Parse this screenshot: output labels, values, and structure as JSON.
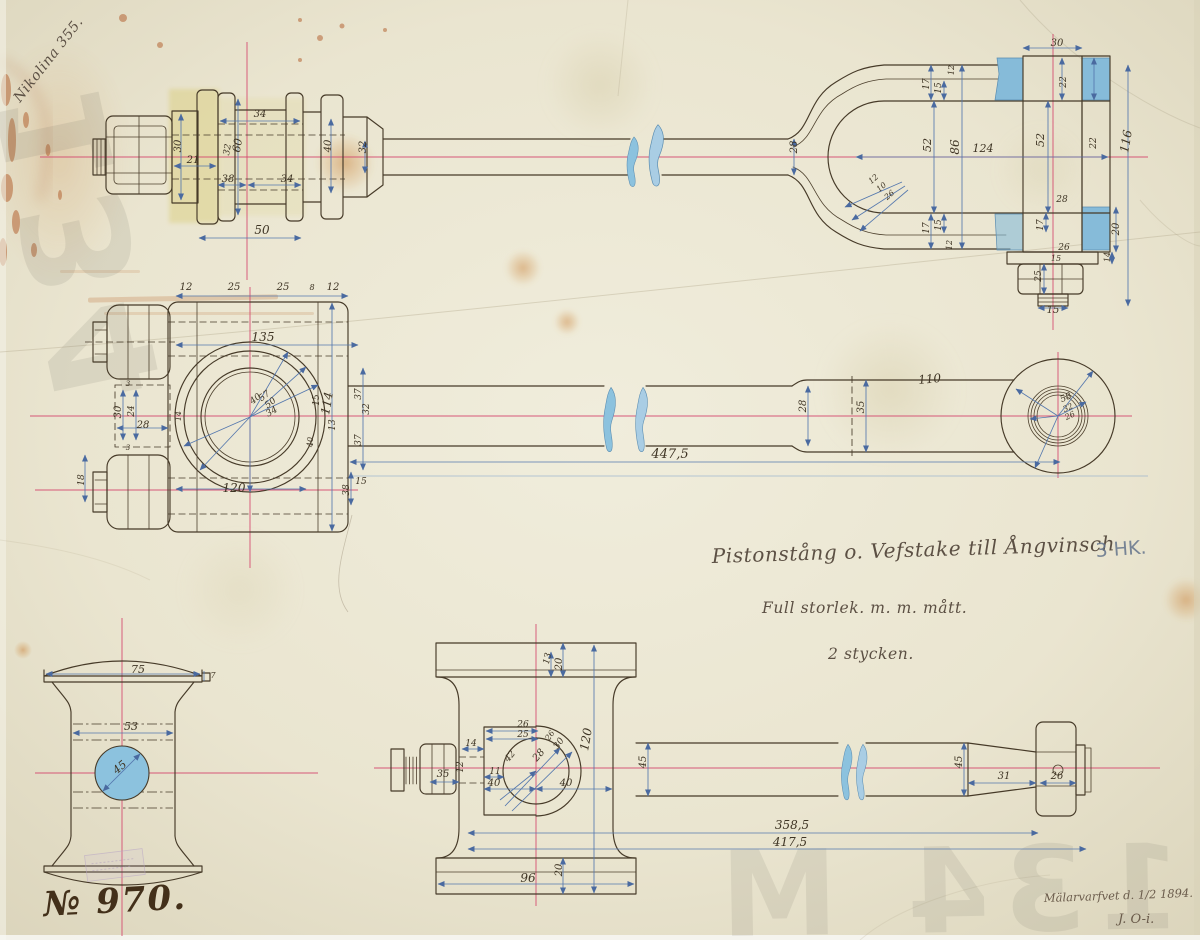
{
  "document": {
    "corner_note": "Nikolina 355.",
    "title": "Pistonstång o. Vefstake till Ångvinsch",
    "power_note": "3 HK.",
    "scale_note": "Full storlek.    m. m. mått.",
    "quantity_note": "2 stycken.",
    "drawing_number": "№ 970.",
    "signature_place_date": "Mälarvarfvet d. 1/2 1894.",
    "signature_initials": "J. O-i.",
    "watermark_top_left": "134",
    "watermark_bottom_right": "134 M"
  },
  "colors": {
    "paper": "#ece7d4",
    "ink": "#463a28",
    "dimension_blue": "#5578ae",
    "centerline_red": "#d4476e",
    "wash_blue": "#86bbd9",
    "wash_yellow": "#d6c867"
  },
  "annotations": [
    {
      "v": "side",
      "t": "34",
      "x": 260,
      "y": 117
    },
    {
      "v": "side",
      "t": "30",
      "x": 181,
      "y": 146,
      "r": -90
    },
    {
      "v": "side",
      "t": "21",
      "x": 193,
      "y": 163
    },
    {
      "v": "side",
      "t": "60",
      "x": 241,
      "y": 146,
      "r": -80,
      "s": 11
    },
    {
      "v": "side",
      "t": "32",
      "x": 230,
      "y": 150,
      "r": -80,
      "s": 9
    },
    {
      "v": "side",
      "t": "38",
      "x": 228,
      "y": 182
    },
    {
      "v": "side",
      "t": "34",
      "x": 287,
      "y": 182
    },
    {
      "v": "side",
      "t": "50",
      "x": 262,
      "y": 234,
      "s": 12
    },
    {
      "v": "side",
      "t": "40",
      "x": 331,
      "y": 146,
      "r": -90
    },
    {
      "v": "side",
      "t": "32",
      "x": 366,
      "y": 147,
      "r": -90
    },
    {
      "v": "side",
      "t": "28",
      "x": 797,
      "y": 147,
      "r": -90
    },
    {
      "v": "side",
      "t": "12",
      "x": 954,
      "y": 70,
      "r": -90,
      "s": 8
    },
    {
      "v": "side",
      "t": "17",
      "x": 929,
      "y": 84,
      "r": -90,
      "s": 9
    },
    {
      "v": "side",
      "t": "15",
      "x": 941,
      "y": 88,
      "r": -90,
      "s": 9
    },
    {
      "v": "side",
      "t": "52",
      "x": 931,
      "y": 145,
      "r": -90,
      "s": 11
    },
    {
      "v": "side",
      "t": "86",
      "x": 959,
      "y": 147,
      "r": -90,
      "s": 12
    },
    {
      "v": "side",
      "t": "124",
      "x": 983,
      "y": 152,
      "s": 11
    },
    {
      "v": "side",
      "t": "30",
      "x": 1057,
      "y": 46
    },
    {
      "v": "side",
      "t": "22",
      "x": 1066,
      "y": 82,
      "r": -90,
      "s": 9
    },
    {
      "v": "side",
      "t": "52",
      "x": 1044,
      "y": 140,
      "r": -90,
      "s": 11
    },
    {
      "v": "side",
      "t": "22",
      "x": 1096,
      "y": 143,
      "r": -90,
      "s": 9
    },
    {
      "v": "side",
      "t": "116",
      "x": 1130,
      "y": 142,
      "r": -80,
      "s": 12
    },
    {
      "v": "side",
      "t": "12",
      "x": 875,
      "y": 181,
      "r": -40,
      "s": 8
    },
    {
      "v": "side",
      "t": "10",
      "x": 883,
      "y": 189,
      "r": -40,
      "s": 8
    },
    {
      "v": "side",
      "t": "26",
      "x": 891,
      "y": 197,
      "r": -40,
      "s": 8
    },
    {
      "v": "side",
      "t": "17",
      "x": 929,
      "y": 228,
      "r": -90,
      "s": 9
    },
    {
      "v": "side",
      "t": "15",
      "x": 941,
      "y": 225,
      "r": -90,
      "s": 9
    },
    {
      "v": "side",
      "t": "12",
      "x": 952,
      "y": 245,
      "r": -90,
      "s": 8
    },
    {
      "v": "side",
      "t": "28",
      "x": 1062,
      "y": 202,
      "s": 9
    },
    {
      "v": "side",
      "t": "17",
      "x": 1043,
      "y": 225,
      "r": -90,
      "s": 9
    },
    {
      "v": "side",
      "t": "26",
      "x": 1064,
      "y": 250,
      "s": 9
    },
    {
      "v": "side",
      "t": "15",
      "x": 1056,
      "y": 261,
      "s": 8
    },
    {
      "v": "side",
      "t": "25",
      "x": 1041,
      "y": 276,
      "r": -90,
      "s": 9
    },
    {
      "v": "side",
      "t": "20",
      "x": 1119,
      "y": 229,
      "r": -90
    },
    {
      "v": "side",
      "t": "14",
      "x": 1110,
      "y": 257,
      "r": -90,
      "s": 8
    },
    {
      "v": "side",
      "t": "15",
      "x": 1053,
      "y": 313
    },
    {
      "v": "plan",
      "t": "12",
      "x": 186,
      "y": 290
    },
    {
      "v": "plan",
      "t": "25",
      "x": 234,
      "y": 290
    },
    {
      "v": "plan",
      "t": "25",
      "x": 283,
      "y": 290
    },
    {
      "v": "plan",
      "t": "8",
      "x": 312,
      "y": 290,
      "s": 8
    },
    {
      "v": "plan",
      "t": "12",
      "x": 333,
      "y": 290
    },
    {
      "v": "plan",
      "t": "135",
      "x": 263,
      "y": 341,
      "s": 12
    },
    {
      "v": "plan",
      "t": "30",
      "x": 121,
      "y": 412,
      "r": -90
    },
    {
      "v": "plan",
      "t": "24",
      "x": 134,
      "y": 411,
      "r": -90,
      "s": 9
    },
    {
      "v": "plan",
      "t": "3",
      "x": 128,
      "y": 386,
      "s": 7
    },
    {
      "v": "plan",
      "t": "3",
      "x": 128,
      "y": 450,
      "s": 7
    },
    {
      "v": "plan",
      "t": "28",
      "x": 143,
      "y": 428
    },
    {
      "v": "plan",
      "t": "14",
      "x": 181,
      "y": 416,
      "r": -90,
      "s": 8
    },
    {
      "v": "plan",
      "t": "40",
      "x": 257,
      "y": 401,
      "r": -38,
      "s": 9
    },
    {
      "v": "plan",
      "t": "57",
      "x": 266,
      "y": 398,
      "r": -38,
      "s": 9
    },
    {
      "v": "plan",
      "t": "50",
      "x": 272,
      "y": 405,
      "r": -38,
      "s": 9
    },
    {
      "v": "plan",
      "t": "34",
      "x": 273,
      "y": 414,
      "r": -30,
      "s": 9
    },
    {
      "v": "plan",
      "t": "120",
      "x": 234,
      "y": 492,
      "s": 12
    },
    {
      "v": "plan",
      "t": "15",
      "x": 319,
      "y": 400,
      "r": -90,
      "s": 9
    },
    {
      "v": "plan",
      "t": "13",
      "x": 335,
      "y": 425,
      "r": -90,
      "s": 9
    },
    {
      "v": "plan",
      "t": "40",
      "x": 313,
      "y": 442,
      "r": -90,
      "s": 8
    },
    {
      "v": "plan",
      "t": "114",
      "x": 331,
      "y": 404,
      "r": -80,
      "s": 12
    },
    {
      "v": "plan",
      "t": "37",
      "x": 361,
      "y": 394,
      "r": -90,
      "s": 9
    },
    {
      "v": "plan",
      "t": "32",
      "x": 369,
      "y": 409,
      "r": -90,
      "s": 9
    },
    {
      "v": "plan",
      "t": "37",
      "x": 361,
      "y": 440,
      "r": -90,
      "s": 9
    },
    {
      "v": "plan",
      "t": "38",
      "x": 349,
      "y": 490,
      "r": -90,
      "s": 9
    },
    {
      "v": "plan",
      "t": "15",
      "x": 361,
      "y": 484,
      "s": 9
    },
    {
      "v": "plan",
      "t": "18",
      "x": 84,
      "y": 480,
      "r": -90,
      "s": 9
    },
    {
      "v": "plan",
      "t": "447,5",
      "x": 670,
      "y": 458,
      "s": 13
    },
    {
      "v": "plan",
      "t": "28",
      "x": 806,
      "y": 406,
      "r": -90
    },
    {
      "v": "plan",
      "t": "35",
      "x": 864,
      "y": 407,
      "r": -90
    },
    {
      "v": "plan",
      "t": "110",
      "x": 930,
      "y": 383,
      "r": -5,
      "s": 12
    },
    {
      "v": "plan",
      "t": "58",
      "x": 1067,
      "y": 400,
      "r": -25,
      "s": 9
    },
    {
      "v": "plan",
      "t": "32",
      "x": 1069,
      "y": 410,
      "r": -25,
      "s": 8
    },
    {
      "v": "plan",
      "t": "26",
      "x": 1071,
      "y": 418,
      "r": -25,
      "s": 8
    },
    {
      "v": "end",
      "t": "75",
      "x": 138,
      "y": 673,
      "s": 11
    },
    {
      "v": "end",
      "t": "7",
      "x": 213,
      "y": 678,
      "s": 8
    },
    {
      "v": "end",
      "t": "53",
      "x": 131,
      "y": 730,
      "s": 11
    },
    {
      "v": "end",
      "t": "45",
      "x": 122,
      "y": 770,
      "r": -40,
      "s": 11
    },
    {
      "v": "piston",
      "t": "13",
      "x": 550,
      "y": 659,
      "r": -78,
      "s": 9
    },
    {
      "v": "piston",
      "t": "20",
      "x": 562,
      "y": 664,
      "r": -90
    },
    {
      "v": "piston",
      "t": "26",
      "x": 523,
      "y": 727,
      "s": 9
    },
    {
      "v": "piston",
      "t": "25",
      "x": 523,
      "y": 737,
      "s": 9
    },
    {
      "v": "piston",
      "t": "14",
      "x": 471,
      "y": 746,
      "s": 9
    },
    {
      "v": "piston",
      "t": "12",
      "x": 463,
      "y": 767,
      "r": -90,
      "s": 9
    },
    {
      "v": "piston",
      "t": "35",
      "x": 443,
      "y": 777
    },
    {
      "v": "piston",
      "t": "11",
      "x": 495,
      "y": 774,
      "s": 9
    },
    {
      "v": "piston",
      "t": "40",
      "x": 494,
      "y": 786
    },
    {
      "v": "piston",
      "t": "40",
      "x": 566,
      "y": 786
    },
    {
      "v": "piston",
      "t": "42",
      "x": 512,
      "y": 758,
      "r": -50,
      "s": 9
    },
    {
      "v": "piston",
      "t": "28",
      "x": 541,
      "y": 757,
      "r": -50
    },
    {
      "v": "piston",
      "t": "30",
      "x": 561,
      "y": 745,
      "r": -55,
      "s": 9
    },
    {
      "v": "piston",
      "t": "26",
      "x": 552,
      "y": 737,
      "r": -55,
      "s": 8
    },
    {
      "v": "piston",
      "t": "120",
      "x": 590,
      "y": 740,
      "r": -80,
      "s": 12
    },
    {
      "v": "piston",
      "t": "45",
      "x": 646,
      "y": 762,
      "r": -90
    },
    {
      "v": "piston",
      "t": "20",
      "x": 562,
      "y": 870,
      "r": -90
    },
    {
      "v": "piston",
      "t": "96",
      "x": 528,
      "y": 882,
      "s": 12
    },
    {
      "v": "piston",
      "t": "45",
      "x": 962,
      "y": 762,
      "r": -90
    },
    {
      "v": "piston",
      "t": "31",
      "x": 1004,
      "y": 779
    },
    {
      "v": "piston",
      "t": "26",
      "x": 1057,
      "y": 779
    },
    {
      "v": "piston",
      "t": "358,5",
      "x": 792,
      "y": 829,
      "s": 12
    },
    {
      "v": "piston",
      "t": "417,5",
      "x": 790,
      "y": 846,
      "s": 12
    }
  ]
}
